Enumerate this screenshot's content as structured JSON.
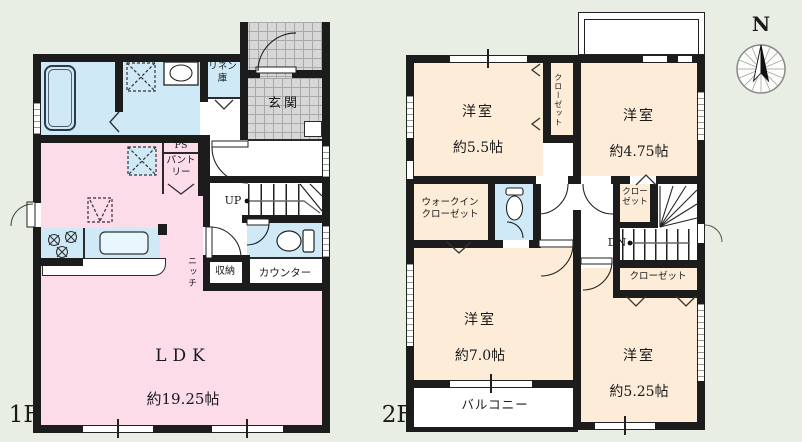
{
  "floor1": {
    "label": "1F",
    "ldk": {
      "name": "LDK",
      "size": "約19.25帖"
    },
    "entrance": "玄関",
    "linen_closet": "リネン\n庫",
    "pipe_space": "PS",
    "pantry": "パント\nリー",
    "stairs_up": "UP",
    "niche": "ニッチ",
    "storage": "収納",
    "counter": "カウンター"
  },
  "floor2": {
    "label": "2F",
    "bedroom_a": {
      "name": "洋室",
      "size": "約5.5帖"
    },
    "bedroom_b": {
      "name": "洋室",
      "size": "約4.75帖"
    },
    "bedroom_c": {
      "name": "洋室",
      "size": "約7.0帖"
    },
    "bedroom_d": {
      "name": "洋室",
      "size": "約5.25帖"
    },
    "closet_between": "クローゼット",
    "walk_in_closet": "ウォークイン\nクローゼット",
    "closet_stairs": "クロー\nゼット",
    "closet_south": "クローゼット",
    "stairs_down": "DN",
    "balcony": "バルコニー"
  },
  "compass": {
    "north": "N"
  }
}
